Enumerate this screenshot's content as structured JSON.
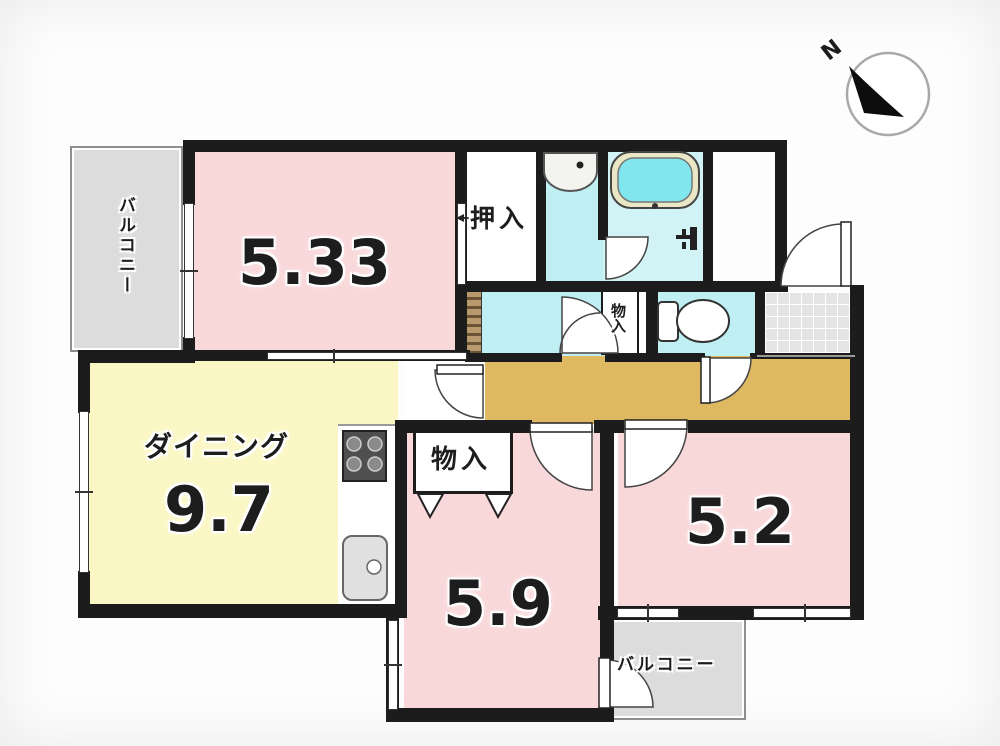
{
  "compass": {
    "north_label": "N"
  },
  "balcony_top_left": {
    "label": "バルコニー"
  },
  "room_533": {
    "area": "5.33"
  },
  "oshiire_closet": {
    "label": "押入"
  },
  "dining": {
    "name": "ダイニング",
    "area": "9.7"
  },
  "storage_room59": {
    "label": "物入"
  },
  "storage_hallway": {
    "label": "物入"
  },
  "room_59": {
    "area": "5.9"
  },
  "room_52": {
    "area": "5.2"
  },
  "balcony_bottom_right": {
    "label": "バルコニー"
  },
  "colors": {
    "wall": "#1c1c1c",
    "room_pink": "#f9d8da",
    "dining_yellow": "#fbf7c5",
    "wet_area_cyan": "#bfeef3",
    "bathroom_cyan": "#d2f3f6",
    "tub_water_cyan": "#82e6ef",
    "tub_rim": "#eae7c6",
    "hallway_tan": "#dfb962",
    "balcony_gray": "#dcdcdc",
    "entrance_tile_gray": "#e4e4e4",
    "counter_hatch_brown": "#a5835c"
  }
}
